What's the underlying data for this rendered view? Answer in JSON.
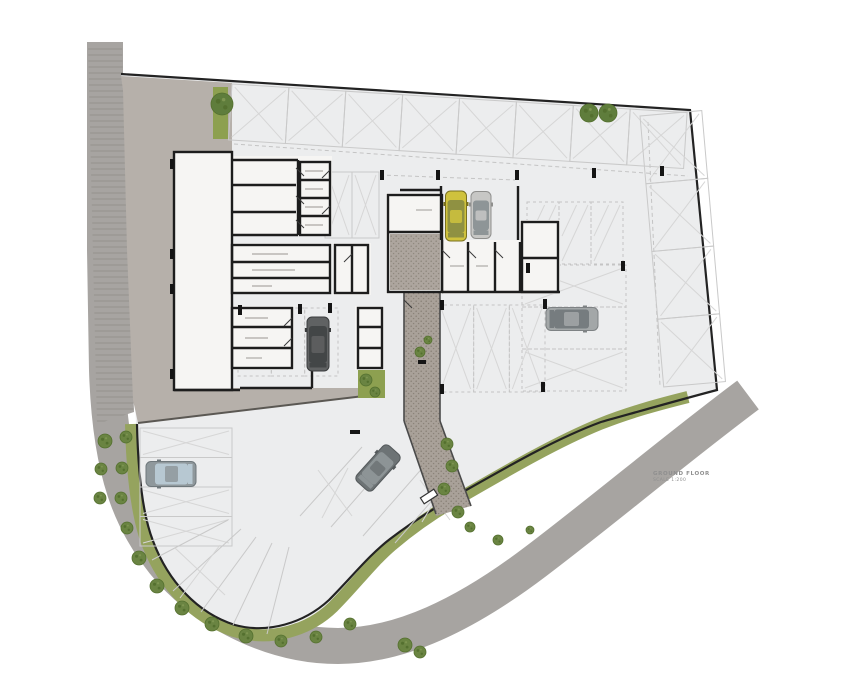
{
  "annotation": {
    "line1": "GROUND FLOOR",
    "line2": "SCALE 1:200"
  },
  "palette": {
    "page": "#ffffff",
    "site": "#ecedee",
    "road": "#a7a4a1",
    "roadHatch": "#96948f",
    "driveway": "#b6b0aa",
    "drivewayEdge": "#5b5853",
    "greenBand": "#95a35e",
    "greenRect": "#8da050",
    "bush": "#6a8442",
    "bushDot": "#54702f",
    "tree": "#5f7d3c",
    "boundary": "#232323",
    "wall": "#1d1d1d",
    "stall": "#c9c9c9",
    "stallX": "#d6d6d6",
    "dashed": "#c4c4c4",
    "building": "#f6f5f3",
    "core": "#b3aba1",
    "walk": "#a9a199",
    "speckle": "#8b8379",
    "tick": "#151515",
    "door": "#3a3a3a",
    "labelMark": "#b8b5b1",
    "pathEdge": "#4a4a4a",
    "gateFill": "#ffffff",
    "gateLine": "#333333"
  },
  "plan": {
    "road": {
      "path": "M105,42 L105,250 L107,370 C110,470 130,525 172,572 C215,618 278,646 338,646 C400,646 465,615 535,562 C605,509 672,452 748,395",
      "width": 36
    },
    "roadHatchPoly": "88,45 122,45 134,412 97,424",
    "sitePoly": "M121,74 L690,110 L717,390 C680,401 645,411 602,423 C556,440 508,468 455,498 C432,511 412,524 391,540 C370,556 352,580 330,602 C305,625 268,636 235,627 C196,615 166,583 151,543 C140,513 136,470 136,424 L130,260 L124,95 Z",
    "boundaryPath": "M137,424 C138,470 142,513 153,541 C168,581 197,613 235,625 C268,634 304,623 329,600 C351,578 369,555 390,539 C411,523 431,510 454,497 C507,467 555,439 601,422 C644,410 679,400 717,390 L690,110 L121,74",
    "greenBandPath": "M131,424 C132,470 136,514 148,545 C164,586 195,618 234,631 C270,642 308,631 333,607 C355,585 372,562 392,545 C412,528 432,514 456,500 C508,470 556,442 600,424 C630,412 660,404 688,397",
    "drivewayPoly": "121,76 232,83 232,152 174,152 174,388 362,388 364,396 138,423 133,400 127,250 123,90",
    "drivewayEdge": [
      138,
      423,
      364,
      396
    ],
    "greenRects": [
      [
        413,
        327,
        23,
        43
      ],
      [
        358,
        370,
        27,
        28
      ],
      [
        213,
        87,
        15,
        52
      ]
    ],
    "walkPoly": "404,292 440,292 440,421 471,506 436,516 404,421",
    "corePatternRect": [
      390,
      234,
      50,
      56
    ],
    "pathEdges": [
      [
        404,
        292,
        404,
        421
      ],
      [
        440,
        292,
        440,
        421
      ],
      [
        404,
        421,
        436,
        514
      ],
      [
        440,
        421,
        471,
        506
      ]
    ],
    "buildingFills": [
      [
        174,
        152,
        58,
        238
      ],
      [
        232,
        156,
        100,
        80
      ],
      [
        232,
        243,
        100,
        50
      ],
      [
        230,
        306,
        64,
        64
      ],
      [
        333,
        243,
        38,
        52
      ],
      [
        355,
        306,
        29,
        64
      ],
      [
        386,
        193,
        58,
        101
      ],
      [
        440,
        240,
        120,
        54
      ],
      [
        520,
        220,
        40,
        74
      ]
    ],
    "wallRects": [
      [
        174,
        152,
        58,
        238
      ],
      [
        300,
        162,
        30,
        73
      ],
      [
        232,
        245,
        98,
        48
      ],
      [
        232,
        308,
        60,
        60
      ],
      [
        358,
        308,
        24,
        60
      ],
      [
        335,
        245,
        33,
        48
      ],
      [
        388,
        195,
        54,
        97
      ],
      [
        522,
        222,
        36,
        70
      ]
    ],
    "wallSegs": [
      [
        232,
        160,
        298,
        160
      ],
      [
        298,
        160,
        298,
        235
      ],
      [
        232,
        235,
        298,
        235
      ],
      [
        232,
        185,
        296,
        185
      ],
      [
        232,
        212,
        296,
        212
      ],
      [
        300,
        180,
        330,
        180
      ],
      [
        300,
        198,
        330,
        198
      ],
      [
        300,
        216,
        330,
        216
      ],
      [
        232,
        262,
        330,
        262
      ],
      [
        232,
        278,
        330,
        278
      ],
      [
        232,
        327,
        292,
        327
      ],
      [
        232,
        348,
        292,
        348
      ],
      [
        358,
        327,
        382,
        327
      ],
      [
        358,
        348,
        382,
        348
      ],
      [
        352,
        245,
        352,
        293
      ],
      [
        388,
        232,
        442,
        232
      ],
      [
        442,
        240,
        442,
        292
      ],
      [
        468,
        242,
        468,
        292
      ],
      [
        495,
        242,
        495,
        292
      ],
      [
        520,
        242,
        520,
        292
      ],
      [
        442,
        292,
        560,
        292
      ],
      [
        522,
        258,
        558,
        258
      ],
      [
        400,
        190,
        442,
        190
      ],
      [
        441,
        186,
        441,
        240
      ],
      [
        518,
        186,
        518,
        240
      ],
      [
        174,
        390,
        240,
        390
      ],
      [
        240,
        388,
        312,
        388
      ],
      [
        312,
        370,
        312,
        388
      ]
    ],
    "doors": [
      [
        296,
        168,
        304,
        176
      ],
      [
        296,
        196,
        304,
        204
      ],
      [
        296,
        220,
        304,
        228
      ],
      [
        330,
        170,
        322,
        178
      ],
      [
        330,
        206,
        322,
        214
      ],
      [
        292,
        318,
        284,
        326
      ],
      [
        292,
        338,
        284,
        346
      ],
      [
        442,
        250,
        450,
        258
      ],
      [
        468,
        250,
        476,
        258
      ],
      [
        495,
        250,
        503,
        258
      ],
      [
        352,
        254,
        344,
        262
      ],
      [
        404,
        300,
        412,
        308
      ]
    ],
    "ticks": [
      [
        170,
        159,
        4,
        10
      ],
      [
        170,
        249,
        4,
        10
      ],
      [
        170,
        284,
        4,
        10
      ],
      [
        170,
        369,
        4,
        10
      ],
      [
        380,
        170,
        4,
        10
      ],
      [
        436,
        170,
        4,
        10
      ],
      [
        515,
        170,
        4,
        10
      ],
      [
        592,
        168,
        4,
        10
      ],
      [
        660,
        166,
        4,
        10
      ],
      [
        526,
        263,
        4,
        10
      ],
      [
        621,
        261,
        4,
        10
      ],
      [
        440,
        300,
        4,
        10
      ],
      [
        543,
        299,
        4,
        10
      ],
      [
        440,
        384,
        4,
        10
      ],
      [
        541,
        382,
        4,
        10
      ],
      [
        238,
        305,
        4,
        10
      ],
      [
        298,
        304,
        4,
        10
      ],
      [
        328,
        303,
        4,
        10
      ],
      [
        418,
        360,
        8,
        4
      ],
      [
        350,
        430,
        10,
        4
      ]
    ],
    "labelMarks": [
      [
        252,
        254,
        288
      ],
      [
        252,
        270,
        295
      ],
      [
        252,
        286,
        272
      ],
      [
        305,
        171,
        323
      ],
      [
        305,
        189,
        323
      ],
      [
        305,
        207,
        323
      ],
      [
        305,
        225,
        323
      ],
      [
        245,
        318,
        268
      ],
      [
        245,
        338,
        268
      ],
      [
        246,
        358,
        262
      ],
      [
        450,
        266,
        464
      ],
      [
        476,
        266,
        488
      ],
      [
        416,
        210,
        432
      ]
    ],
    "dashedLines": [
      [
        234,
        144,
        688,
        176
      ],
      [
        648,
        122,
        660,
        386
      ],
      [
        380,
        175,
        515,
        180
      ]
    ],
    "parkingGroups": [
      {
        "x": 232,
        "y": 84,
        "w": 456,
        "h": 56,
        "dir": "cols",
        "count": 8,
        "angle": 3.6,
        "cross": true,
        "dashed": false
      },
      {
        "x": 640,
        "y": 116,
        "w": 62,
        "h": 272,
        "dir": "rows",
        "count": 4,
        "angle": -5,
        "cross": true,
        "dashed": false
      },
      {
        "x": 325,
        "y": 172,
        "w": 54,
        "h": 66,
        "dir": "cols",
        "count": 2,
        "angle": 0,
        "cross": true,
        "dashed": false
      },
      {
        "x": 527,
        "y": 202,
        "w": 96,
        "h": 62,
        "dir": "cols",
        "count": 3,
        "angle": 0,
        "cross": false,
        "hatch": "diag",
        "dashed": true
      },
      {
        "x": 522,
        "y": 265,
        "w": 104,
        "h": 126,
        "dir": "rows",
        "count": 3,
        "angle": 0,
        "cross": [
          true,
          false,
          true
        ],
        "dashed": true
      },
      {
        "x": 438,
        "y": 305,
        "w": 107,
        "h": 87,
        "dir": "cols",
        "count": 3,
        "angle": 0,
        "cross": true,
        "dashed": true
      },
      {
        "x": 238,
        "y": 308,
        "w": 100,
        "h": 68,
        "dir": "cols",
        "count": 3,
        "angle": 0,
        "cross": false,
        "dashed": true
      },
      {
        "x": 140,
        "y": 428,
        "w": 92,
        "h": 118,
        "dir": "rows",
        "count": 4,
        "angle": 0,
        "cross": [
          true,
          false,
          true,
          true
        ],
        "dashed": false
      }
    ],
    "decorLines": [
      [
        228,
        520,
        152,
        560
      ],
      [
        241,
        529,
        173,
        591
      ],
      [
        256,
        537,
        201,
        612
      ],
      [
        272,
        543,
        233,
        625
      ],
      [
        289,
        547,
        267,
        634
      ],
      [
        300,
        516,
        362,
        447
      ],
      [
        331,
        527,
        393,
        456
      ],
      [
        363,
        536,
        425,
        465
      ],
      [
        395,
        543,
        457,
        472
      ]
    ],
    "decorCross": [
      [
        175,
        548,
        225,
        595
      ],
      [
        220,
        545,
        180,
        598
      ],
      [
        318,
        470,
        352,
        516
      ],
      [
        348,
        468,
        322,
        518
      ],
      [
        420,
        480,
        450,
        520
      ],
      [
        448,
        478,
        422,
        522
      ]
    ],
    "cars": [
      {
        "cx": 456,
        "cy": 216,
        "w": 21,
        "len": 50,
        "rot": 0,
        "body": "#cfc23d",
        "glass": "#8f9142",
        "line": "#7a711f"
      },
      {
        "cx": 481,
        "cy": 215,
        "w": 20,
        "len": 47,
        "rot": 0,
        "body": "#c7c7c5",
        "glass": "#8e9597",
        "line": "#8f8f8d"
      },
      {
        "cx": 318,
        "cy": 344,
        "w": 22,
        "len": 54,
        "rot": 0,
        "body": "#606263",
        "glass": "#434647",
        "line": "#3a3c3d"
      },
      {
        "cx": 572,
        "cy": 319,
        "w": 23,
        "len": 52,
        "rot": 90,
        "body": "#a3a7a8",
        "glass": "#767c7f",
        "line": "#7e8284"
      },
      {
        "cx": 171,
        "cy": 474,
        "w": 25,
        "len": 50,
        "rot": -90,
        "body": "#8f989c",
        "glass": "#b7c8d2",
        "line": "#6f787c"
      },
      {
        "cx": 378,
        "cy": 468,
        "w": 22,
        "len": 48,
        "rot": 42,
        "body": "#6d7375",
        "glass": "#8d9496",
        "line": "#54595b"
      }
    ],
    "trees": [
      [
        222,
        104,
        11
      ],
      [
        589,
        113,
        9
      ],
      [
        608,
        113,
        9
      ]
    ],
    "bushes": [
      [
        105,
        441,
        7
      ],
      [
        101,
        469,
        6
      ],
      [
        100,
        498,
        6
      ],
      [
        126,
        437,
        6
      ],
      [
        122,
        468,
        6
      ],
      [
        121,
        498,
        6
      ],
      [
        127,
        528,
        6
      ],
      [
        139,
        558,
        7
      ],
      [
        157,
        586,
        7
      ],
      [
        182,
        608,
        7
      ],
      [
        212,
        624,
        7
      ],
      [
        246,
        636,
        7
      ],
      [
        281,
        641,
        6
      ],
      [
        316,
        637,
        6
      ],
      [
        350,
        624,
        6
      ],
      [
        405,
        645,
        7
      ],
      [
        420,
        652,
        6
      ],
      [
        447,
        444,
        6
      ],
      [
        452,
        466,
        6
      ],
      [
        444,
        489,
        6
      ],
      [
        420,
        352,
        5
      ],
      [
        428,
        340,
        4
      ],
      [
        366,
        380,
        6
      ],
      [
        375,
        392,
        5
      ],
      [
        458,
        512,
        6
      ],
      [
        470,
        527,
        5
      ],
      [
        498,
        540,
        5
      ],
      [
        530,
        530,
        4
      ]
    ],
    "gate": {
      "x": 421,
      "y": 493,
      "w": 16,
      "h": 7,
      "rot": -33
    }
  }
}
